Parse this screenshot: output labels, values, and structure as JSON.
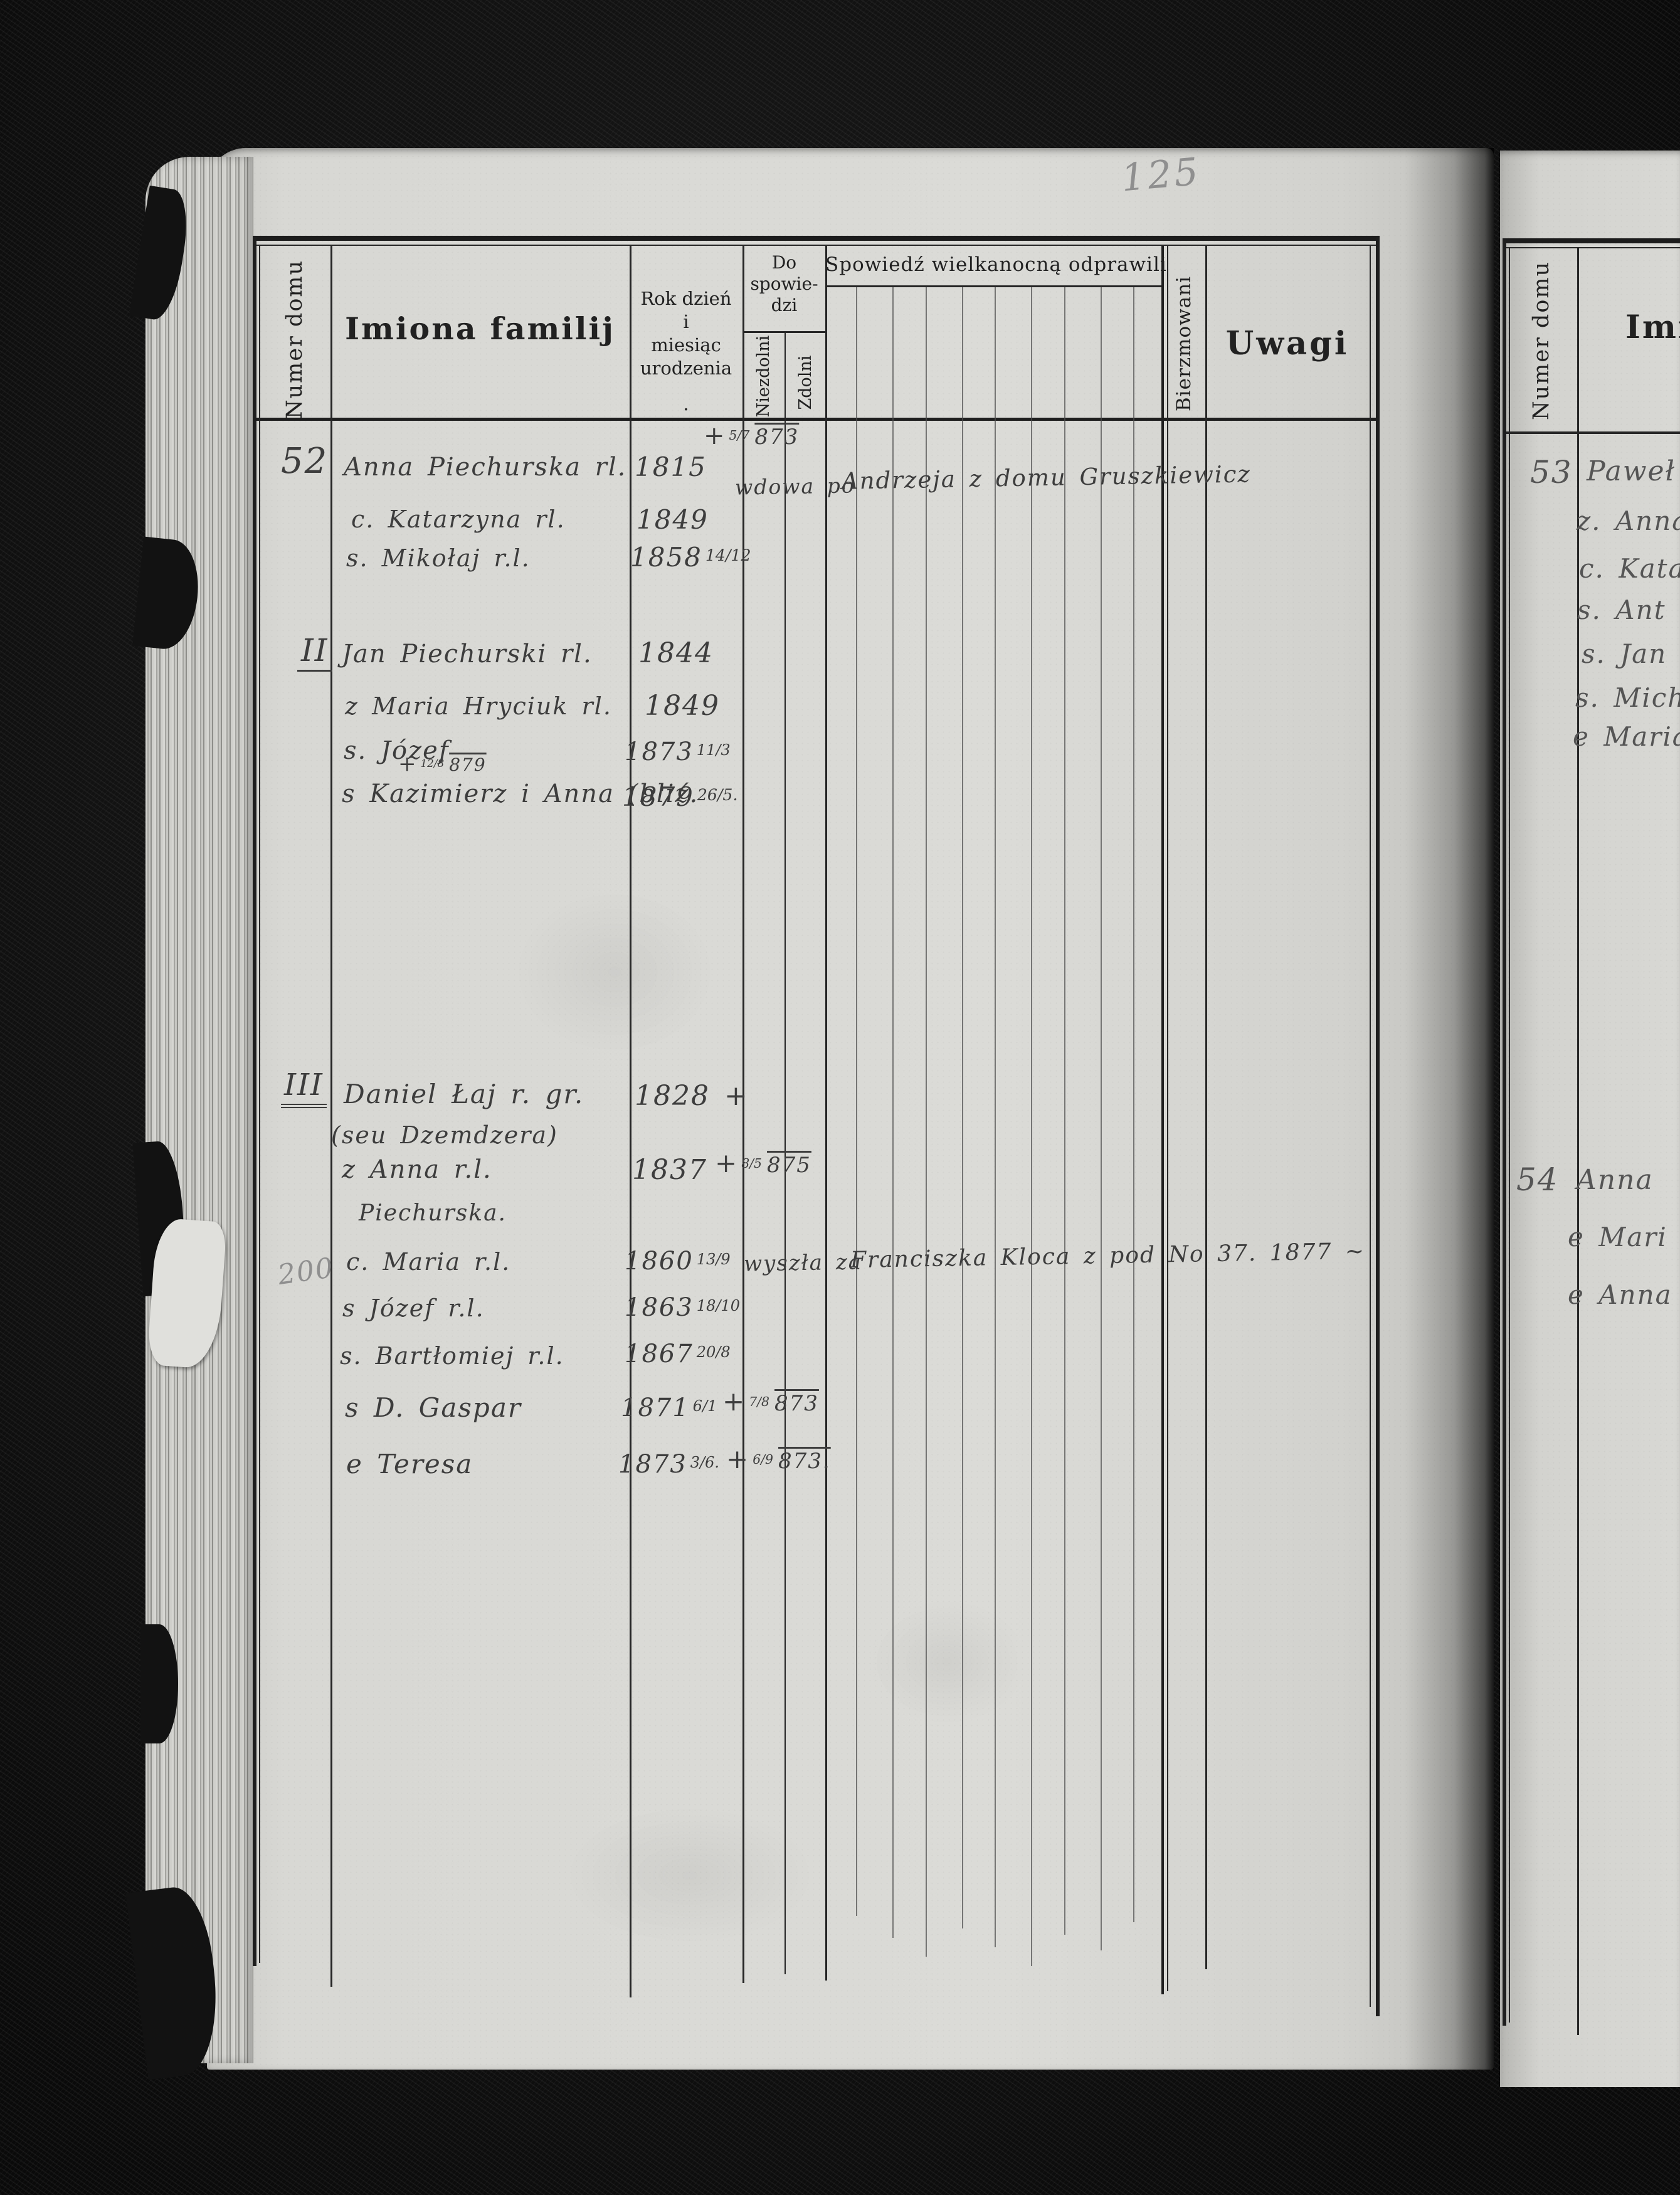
{
  "page_number": "125",
  "left_page": {
    "header": {
      "numer_domu": "Numer domu",
      "imiona": "Imiona familij",
      "rok_line1": "Rok dzień",
      "rok_line2": "i",
      "rok_line3": "miesiąc",
      "rok_line4": "urodzenia",
      "rok_dot": ".",
      "do_line1": "Do",
      "do_line2": "spowie-",
      "do_line3": "dzi",
      "niezdolni": "Niezdolni",
      "zdolni": "Zdolni",
      "spowiedz": "Spowiedź wielkanocną odprawili",
      "bierzmowani": "Bierzmowani",
      "uwagi": "Uwagi"
    },
    "margin_note": "200",
    "entries": [
      {
        "house": "52",
        "name": "Anna Piechurska rl.",
        "birth": "1815",
        "death_plus": "+",
        "death_frac": "5/7",
        "death_year": "873",
        "status": "wdowa po",
        "note": "Andrzeja z domu Gruszkiewicz"
      },
      {
        "name": "c. Katarzyna rl.",
        "birth": "1849"
      },
      {
        "name": "s. Mikołaj r.l.",
        "birth": "1858",
        "birth_frac": "14/12"
      },
      {
        "house": "II",
        "name": "Jan Piechurski rl.",
        "birth": "1844"
      },
      {
        "name": "z Maria Hryciuk rl.",
        "birth": "1849"
      },
      {
        "name": "s. Józef",
        "birth": "1873",
        "birth_frac": "11/3"
      },
      {
        "above_plus": "+",
        "above_frac": "12/8",
        "above_year": "879",
        "name": "s Kazimierz i Anna (bliź.",
        "birth": "1879",
        "birth_frac": "26/5."
      },
      {
        "house": "III",
        "name": "Daniel Łaj r. gr.",
        "name2": "(seu Dzemdzera)",
        "birth": "1828 +"
      },
      {
        "name": "z Anna r.l.",
        "name2": "Piechurska.",
        "birth": "1837",
        "death_plus": "+",
        "death_frac": "8/5",
        "death_year": "875"
      },
      {
        "name": "c. Maria r.l.",
        "birth": "1860",
        "birth_frac": "13/9",
        "status": "wyszła za",
        "note": "Franciszka Kloca z pod No 37. 1877 ~"
      },
      {
        "name": "s Józef r.l.",
        "birth": "1863",
        "birth_frac": "18/10"
      },
      {
        "name": "s. Bartłomiej r.l.",
        "birth": "1867",
        "birth_frac": "20/8"
      },
      {
        "name": "s D. Gaspar",
        "birth": "1871",
        "birth_frac": "6/1",
        "death_plus": "+",
        "death_frac": "7/8",
        "death_year": "873"
      },
      {
        "name": "e Teresa",
        "birth": "1873",
        "birth_frac": "3/6.",
        "death_plus": "+",
        "death_frac": "6/9",
        "death_year": "873."
      }
    ]
  },
  "right_page": {
    "header": {
      "numer_domu": "Numer domu",
      "imiona_fragment": "Imio"
    },
    "entries": [
      {
        "house": "53",
        "lines": [
          "Paweł",
          "z. Anna",
          "c. Kata",
          "s. Ant",
          "s. Jan",
          "s. Mich",
          "e Maria"
        ]
      },
      {
        "house": "54",
        "lines": [
          "Anna",
          "e Mari",
          "e Anna"
        ]
      }
    ]
  }
}
